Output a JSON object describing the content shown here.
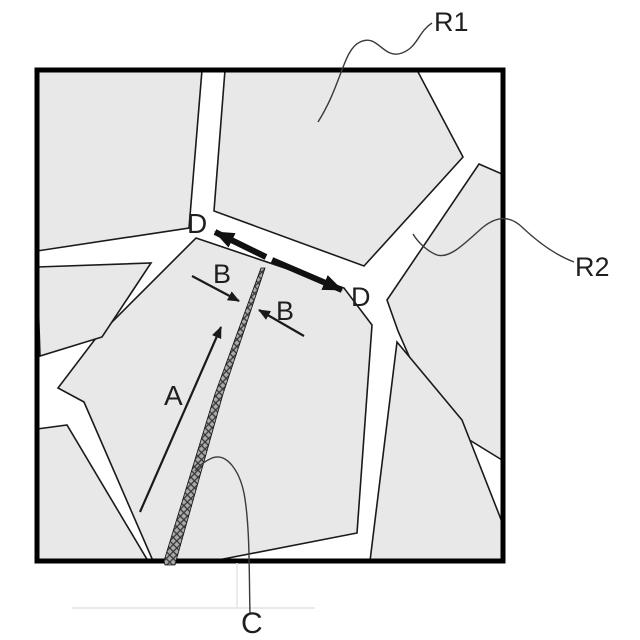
{
  "diagram": {
    "kind": "grain-boundary microstructure patent figure",
    "region_labels": {
      "r1": "R1",
      "r2": "R2"
    },
    "annotation_labels": {
      "d_left": "D",
      "d_right": "D",
      "b_left": "B",
      "b_right": "B",
      "a": "A",
      "c": "C"
    },
    "colors": {
      "background": "#ffffff",
      "grain_fill": "#e8e8e8",
      "outline": "#1a1a1a",
      "frame": "#000000",
      "crack_fill": "#ababab",
      "crack_hatch": "#333333",
      "leader": "#3a3a3a",
      "artifact_line": "#e4e4e4"
    }
  }
}
